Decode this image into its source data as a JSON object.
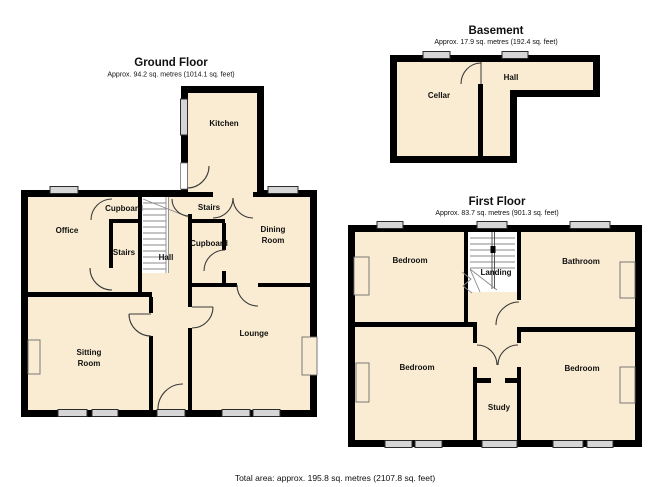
{
  "colors": {
    "wall": "#000000",
    "floor_fill": "#FAECD2",
    "window_fill": "#D6D6D6",
    "stair_area": "#FFFFFF",
    "background": "#FFFFFF"
  },
  "ground_floor": {
    "title": "Ground Floor",
    "area_label": "Approx.  94.2 sq. metres (1014.1 sq. feet)",
    "rooms": {
      "kitchen": "Kitchen",
      "office": "Office",
      "cupboard_top": "Cupboard",
      "stairs_left": "Stairs",
      "hall": "Hall",
      "stairs_right": "Stairs",
      "cupboard_right": "Cupboard",
      "dining_room": [
        "Dining",
        "Room"
      ],
      "sitting_room": [
        "Sitting",
        "Room"
      ],
      "lounge": "Lounge"
    }
  },
  "basement": {
    "title": "Basement",
    "area_label": "Approx.  17.9 sq. metres (192.4 sq. feet)",
    "rooms": {
      "cellar": "Cellar",
      "hall": "Hall"
    }
  },
  "first_floor": {
    "title": "First Floor",
    "area_label": "Approx.  83.7 sq. metres (901.3 sq. feet)",
    "rooms": {
      "bedroom_top_left": "Bedroom",
      "landing": "Landing",
      "bathroom": "Bathroom",
      "bedroom_bottom_left": "Bedroom",
      "study": "Study",
      "bedroom_bottom_right": "Bedroom"
    }
  },
  "footer": {
    "total_area": "Total area: approx. 195.8 sq. metres (2107.8 sq. feet)"
  }
}
